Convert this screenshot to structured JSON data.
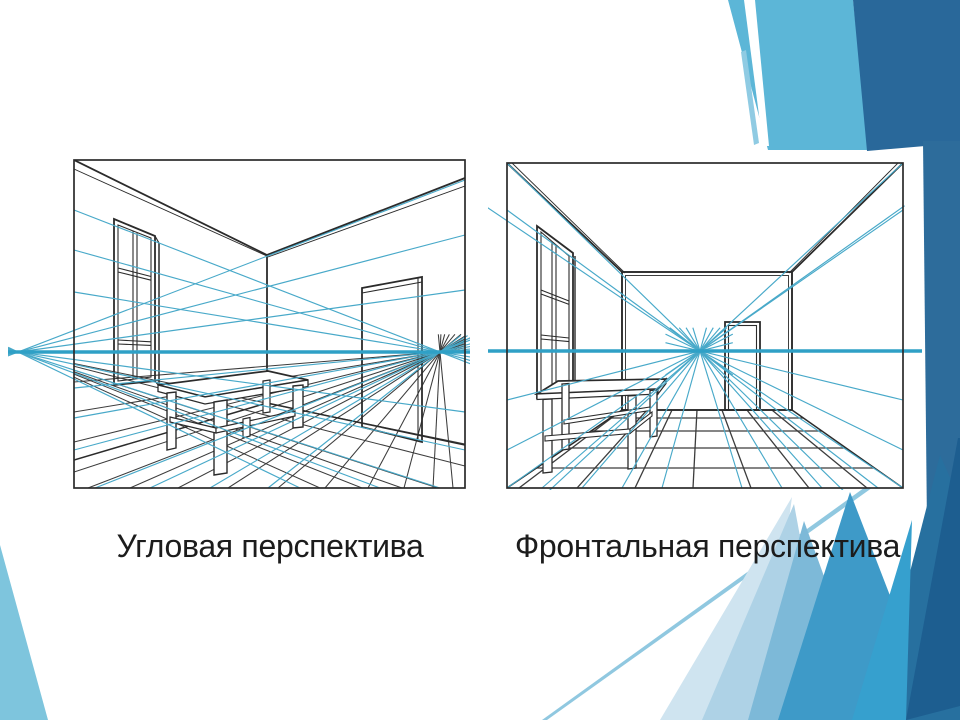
{
  "captions": {
    "left": "Угловая перспектива",
    "right": "Фронтальная перспектива"
  },
  "colors": {
    "background": "#ffffff",
    "caption_text": "#1c1c1c",
    "ink": "#2b2b2b",
    "ink_light": "#3c3c3c",
    "horizon": "#2fa0c6",
    "construction": "#48a9c9",
    "decor_light_blue": "#5cb6d7",
    "decor_sliver_blue": "#8fcbe3",
    "decor_dark_blue": "#29689a",
    "decor_band_blue": "#2d6c9b",
    "decor_wedge_blue": "#7ec5dd",
    "decor_line_blue": "#90c8e0",
    "decor_pale_1": "#cfe4f0",
    "decor_pale_2": "#aed2e6",
    "decor_mid_1": "#7db9d8",
    "decor_mid_2": "#3e9ac8",
    "decor_deep_1": "#27709f",
    "decor_navy": "#1d5e90",
    "decor_accent": "#36a0ce"
  }
}
